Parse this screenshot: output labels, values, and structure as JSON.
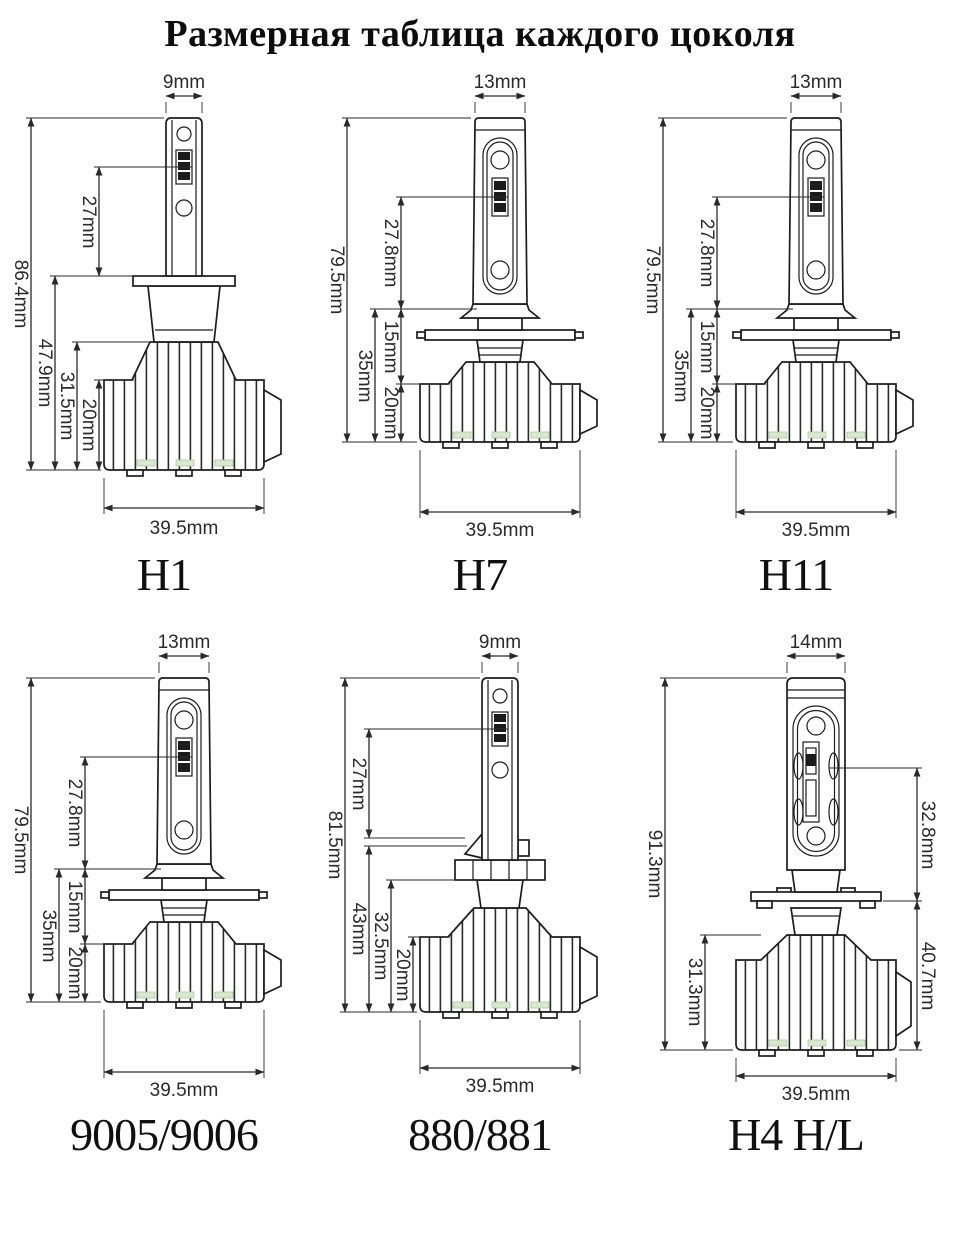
{
  "title": "Размерная таблица каждого цоколя",
  "bulbs": [
    {
      "name": "H1",
      "dims": {
        "top_width": "9mm",
        "total_height": "86.4mm",
        "chip_height": "27mm",
        "lower_height": "47.9mm",
        "sink_height": "31.5mm",
        "fin_height": "20mm",
        "base_width": "39.5mm"
      }
    },
    {
      "name": "H7",
      "dims": {
        "top_width": "13mm",
        "total_height": "79.5mm",
        "chip_height": "27.8mm",
        "neck_height": "15mm",
        "sink_height": "35mm",
        "fin_height": "20mm",
        "base_width": "39.5mm"
      }
    },
    {
      "name": "H11",
      "dims": {
        "top_width": "13mm",
        "total_height": "79.5mm",
        "chip_height": "27.8mm",
        "neck_height": "15mm",
        "sink_height": "35mm",
        "fin_height": "20mm",
        "base_width": "39.5mm"
      }
    },
    {
      "name": "9005/9006",
      "dims": {
        "top_width": "13mm",
        "total_height": "79.5mm",
        "chip_height": "27.8mm",
        "neck_height": "15mm",
        "sink_height": "35mm",
        "fin_height": "20mm",
        "base_width": "39.5mm"
      }
    },
    {
      "name": "880/881",
      "dims": {
        "top_width": "9mm",
        "total_height": "81.5mm",
        "chip_height": "27mm",
        "lower_height": "43mm",
        "sink_height": "32.5mm",
        "fin_height": "20mm",
        "base_width": "39.5mm"
      }
    },
    {
      "name": "H4 H/L",
      "dims": {
        "top_width": "14mm",
        "total_height": "91.3mm",
        "chip_height": "32.8mm",
        "sink_height": "31.3mm",
        "lower_height": "40.7mm",
        "base_width": "39.5mm"
      }
    }
  ]
}
